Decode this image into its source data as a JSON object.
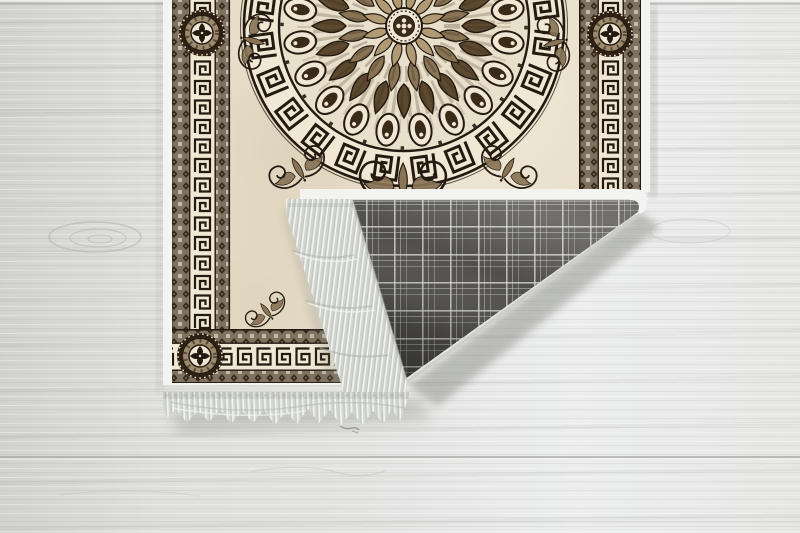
{
  "scene": {
    "label": "patterned-rug-with-folded-corner-on-white-wood-floor",
    "objects": [
      "wood-floor",
      "ornamental-rug",
      "greek-key-borders",
      "mandala-medallion",
      "folded-corner",
      "plaid-backing",
      "fringe-tassels",
      "soft-shadows"
    ]
  },
  "colors": {
    "floor_base": "#dfe0de",
    "floor_light": "#eceded",
    "floor_dark": "#d2d3d1",
    "floor_seam": "#a3a4a0",
    "rug_field": "#e8dfcb",
    "field_shade": "#cbbc9e",
    "key_cream": "#f0e8d5",
    "ink_dark": "#241a10",
    "guard_brown": "#7e7260",
    "guard_dark": "#3a2c1a",
    "brown_mid": "#8a7456",
    "brown_deep": "#5c4930",
    "brown_light": "#b09a74",
    "plaid_base": "#504f4c",
    "plaid_line": "#d4d5d0",
    "fringe_base": "#e9ebe7",
    "fringe_line": "#c2c4c0",
    "binding_white": "#f3f4f1",
    "shadow": "#83857f"
  },
  "mandala": {
    "cx": 404,
    "cy": 26,
    "ring_outer_r": 160,
    "ring_inner_r": 125,
    "layers": [
      {
        "unit": "ring-key",
        "count": 24,
        "offset": 7.5
      },
      {
        "unit": "eye",
        "count": 20,
        "offset": 9
      },
      {
        "unit": "petal-outer",
        "count": 20,
        "offset": 0
      },
      {
        "unit": "petal-mid",
        "count": 16,
        "offset": 11.25
      },
      {
        "unit": "petal-inner",
        "count": 12,
        "offset": 15
      }
    ]
  },
  "border": {
    "style": "greek-key-meander",
    "rosettes": [
      {
        "x": 202,
        "y": 33
      },
      {
        "x": 610,
        "y": 34
      },
      {
        "x": 200,
        "y": 356
      }
    ]
  },
  "ornaments": {
    "flourishes": [
      {
        "x": 403,
        "y": 186,
        "rotate": 0,
        "scale": 1.15
      },
      {
        "x": 300,
        "y": 172,
        "rotate": -30,
        "scale": 0.8
      },
      {
        "x": 506,
        "y": 172,
        "rotate": 30,
        "scale": 0.8
      },
      {
        "x": 250,
        "y": 40,
        "rotate": 105,
        "scale": 0.75
      },
      {
        "x": 558,
        "y": 42,
        "rotate": -105,
        "scale": 0.75
      },
      {
        "x": 268,
        "y": 313,
        "rotate": -38,
        "scale": 0.6
      }
    ]
  },
  "fold": {
    "backing_pattern": "gray-tartan-plaid",
    "crease_y": 192,
    "triangle": [
      [
        352,
        199
      ],
      [
        634,
        199
      ],
      [
        405,
        380
      ]
    ]
  }
}
